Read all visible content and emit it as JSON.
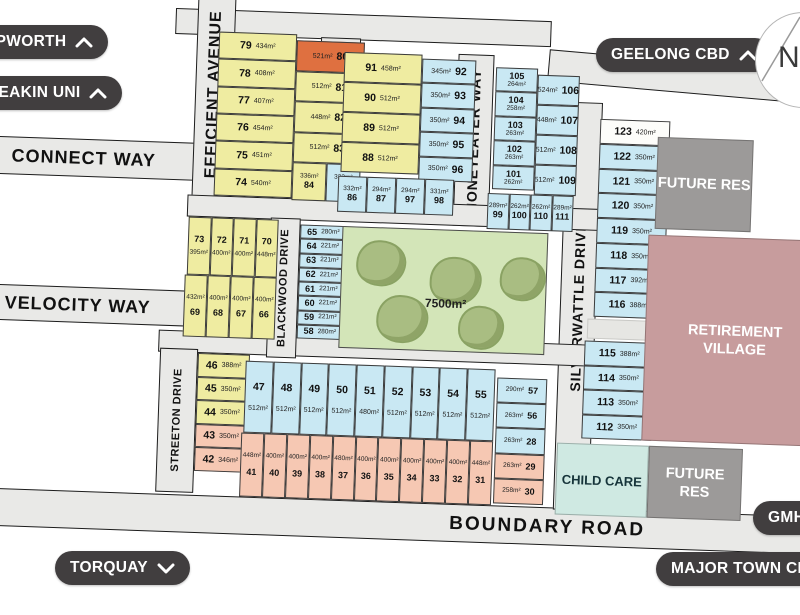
{
  "map": {
    "streets": {
      "efficient": "EFFICIENT  AVENUE",
      "yellow_gum": "YELLOW GUM WAY",
      "honeyeater": "HONEYEATER WAY",
      "silverwattle": "SILVERWATTLE DRIVE",
      "blackwood": "BLACKWOOD DRIVE",
      "streeton": "STREETON DRIVE",
      "connect": "CONNECT WAY",
      "velocity": "VELOCITY WAY",
      "boundary": "BOUNDARY  ROAD"
    },
    "park": {
      "area": "7500m²"
    },
    "features": {
      "retirement_village": "RETIREMENT VILLAGE",
      "future_res_top": "FUTURE RES",
      "future_res_bottom": "FUTURE RES",
      "child_care": "CHILD CARE"
    },
    "compass": "N",
    "lot_groups": {
      "g1_left": [
        {
          "n": "79",
          "a": "434m²"
        },
        {
          "n": "78",
          "a": "408m²"
        },
        {
          "n": "77",
          "a": "407m²"
        },
        {
          "n": "76",
          "a": "454m²"
        },
        {
          "n": "75",
          "a": "451m²"
        },
        {
          "n": "74",
          "a": "540m²"
        }
      ],
      "g1_right": [
        {
          "n": "80",
          "a": "521m²",
          "c": "orange"
        },
        {
          "n": "81",
          "a": "512m²"
        },
        {
          "n": "82",
          "a": "448m²"
        },
        {
          "n": "83",
          "a": "512m²"
        }
      ],
      "g1_bottom": [
        {
          "n": "84",
          "a": "336m²",
          "c": "yellow"
        },
        {
          "n": "85",
          "a": "332m²",
          "c": "blue"
        }
      ],
      "g2_left": [
        {
          "n": "91",
          "a": "458m²"
        },
        {
          "n": "90",
          "a": "512m²"
        },
        {
          "n": "89",
          "a": "512m²"
        },
        {
          "n": "88",
          "a": "512m²"
        }
      ],
      "g2_right": [
        {
          "n": "92",
          "a": "345m²"
        },
        {
          "n": "93",
          "a": "350m²"
        },
        {
          "n": "94",
          "a": "350m²"
        },
        {
          "n": "95",
          "a": "350m²"
        },
        {
          "n": "96",
          "a": "350m²"
        }
      ],
      "g2_bottom": [
        {
          "n": "86",
          "a": "332m²"
        },
        {
          "n": "87",
          "a": "294m²"
        },
        {
          "n": "97",
          "a": "294m²"
        },
        {
          "n": "98",
          "a": "331m²"
        }
      ],
      "g3_left": [
        {
          "n": "105",
          "a": "264m²"
        },
        {
          "n": "104",
          "a": "258m²"
        },
        {
          "n": "103",
          "a": "263m²"
        },
        {
          "n": "102",
          "a": "263m²"
        },
        {
          "n": "101",
          "a": "262m²"
        }
      ],
      "g3_right": [
        {
          "n": "106",
          "a": "524m²"
        },
        {
          "n": "107",
          "a": "448m²"
        },
        {
          "n": "108",
          "a": "512m²"
        },
        {
          "n": "109",
          "a": "512m²"
        }
      ],
      "g3_bottom": [
        {
          "n": "99",
          "a": "289m²"
        },
        {
          "n": "100",
          "a": "262m²"
        },
        {
          "n": "110",
          "a": "262m²"
        },
        {
          "n": "111",
          "a": "289m²"
        }
      ],
      "g4_top": [
        {
          "n": "123",
          "a": "420m²",
          "c": "white"
        },
        {
          "n": "122",
          "a": "350m²"
        },
        {
          "n": "121",
          "a": "350m²"
        },
        {
          "n": "120",
          "a": "350m²"
        },
        {
          "n": "119",
          "a": "350m²"
        },
        {
          "n": "118",
          "a": "350m²"
        },
        {
          "n": "117",
          "a": "392m²"
        },
        {
          "n": "116",
          "a": "388m²"
        }
      ],
      "g4_bottom": [
        {
          "n": "115",
          "a": "388m²"
        },
        {
          "n": "114",
          "a": "350m²"
        },
        {
          "n": "113",
          "a": "350m²"
        },
        {
          "n": "112",
          "a": "350m²"
        }
      ],
      "g5_top": [
        {
          "n": "73",
          "a": "395m²"
        },
        {
          "n": "72",
          "a": "400m²"
        },
        {
          "n": "71",
          "a": "400m²"
        },
        {
          "n": "70",
          "a": "448m²"
        }
      ],
      "g5_bottom": [
        {
          "n": "69",
          "a": "432m²"
        },
        {
          "n": "68",
          "a": "400m²"
        },
        {
          "n": "67",
          "a": "400m²"
        },
        {
          "n": "66",
          "a": "400m²"
        }
      ],
      "g6": [
        {
          "n": "65",
          "a": "280m²"
        },
        {
          "n": "64",
          "a": "221m²"
        },
        {
          "n": "63",
          "a": "221m²"
        },
        {
          "n": "62",
          "a": "221m²"
        },
        {
          "n": "61",
          "a": "221m²"
        },
        {
          "n": "60",
          "a": "221m²"
        },
        {
          "n": "59",
          "a": "221m²"
        },
        {
          "n": "58",
          "a": "280m²"
        }
      ],
      "g7_streeton": [
        {
          "n": "46",
          "a": "388m²",
          "c": "yellow"
        },
        {
          "n": "45",
          "a": "350m²",
          "c": "yellow"
        },
        {
          "n": "44",
          "a": "350m²",
          "c": "yellow"
        },
        {
          "n": "43",
          "a": "350m²",
          "c": "salmon"
        },
        {
          "n": "42",
          "a": "346m²",
          "c": "salmon"
        }
      ],
      "g7_blue": [
        {
          "n": "47",
          "a": "512m²"
        },
        {
          "n": "48",
          "a": "512m²"
        },
        {
          "n": "49",
          "a": "512m²"
        },
        {
          "n": "50",
          "a": "512m²"
        },
        {
          "n": "51",
          "a": "480m²"
        },
        {
          "n": "52",
          "a": "512m²"
        },
        {
          "n": "53",
          "a": "512m²"
        },
        {
          "n": "54",
          "a": "512m²"
        },
        {
          "n": "55",
          "a": "512m²"
        }
      ],
      "g7_right": [
        {
          "n": "57",
          "a": "290m²",
          "c": "blue"
        },
        {
          "n": "56",
          "a": "263m²",
          "c": "blue"
        },
        {
          "n": "28",
          "a": "263m²",
          "c": "blue"
        },
        {
          "n": "29",
          "a": "263m²",
          "c": "salmon"
        },
        {
          "n": "30",
          "a": "258m²",
          "c": "salmon"
        }
      ],
      "g7_salmon": [
        {
          "n": "41",
          "a": "448m²"
        },
        {
          "n": "40",
          "a": "400m²"
        },
        {
          "n": "39",
          "a": "400m²"
        },
        {
          "n": "38",
          "a": "400m²"
        },
        {
          "n": "37",
          "a": "480m²"
        },
        {
          "n": "36",
          "a": "400m²"
        },
        {
          "n": "35",
          "a": "400m²"
        },
        {
          "n": "34",
          "a": "400m²"
        },
        {
          "n": "33",
          "a": "400m²"
        },
        {
          "n": "32",
          "a": "400m²"
        },
        {
          "n": "31",
          "a": "448m²"
        }
      ]
    },
    "colors": {
      "yellow_lot": "#efeca1",
      "blue_lot": "#c9e8f3",
      "salmon_lot": "#f6c8b3",
      "orange_lot": "#df7040",
      "park": "#d3e5b8",
      "tree": "#a9bd82",
      "road": "#e9e9e7",
      "retirement": "#c79c9d",
      "future_res": "#9c9a99",
      "child_care": "#cfe9e2",
      "button": "#413e3f"
    }
  },
  "buttons": {
    "epworth": "EPWORTH",
    "deakin": "DEAKIN UNI",
    "geelong": "GEELONG CBD",
    "torquay": "TORQUAY",
    "gmhba": "GMHBA",
    "major_town_centre": "MAJOR TOWN CENTRE"
  }
}
